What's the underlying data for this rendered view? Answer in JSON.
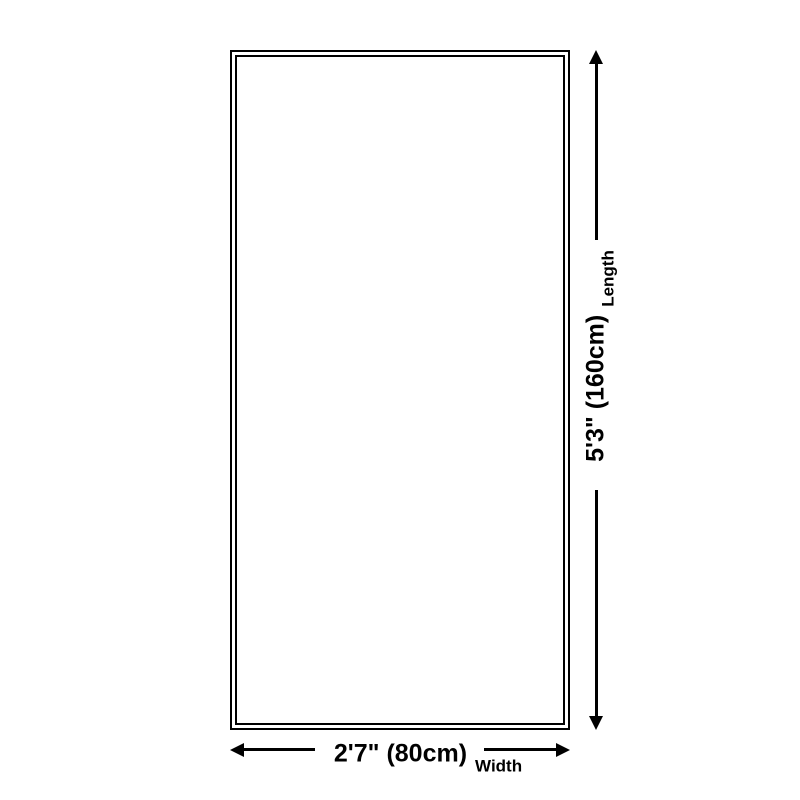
{
  "diagram_title": "product-dimension-diagram",
  "length_dimension": {
    "value": "5'3\" (160cm)",
    "label": "Length"
  },
  "width_dimension": {
    "value": "2'7\" (80cm)",
    "label": "Width"
  },
  "icons": {
    "arrow_up": "css-triangle-up",
    "arrow_down": "css-triangle-down",
    "arrow_left": "css-triangle-left",
    "arrow_right": "css-triangle-right"
  },
  "colors": {
    "line": "#000000",
    "background": "#ffffff"
  }
}
